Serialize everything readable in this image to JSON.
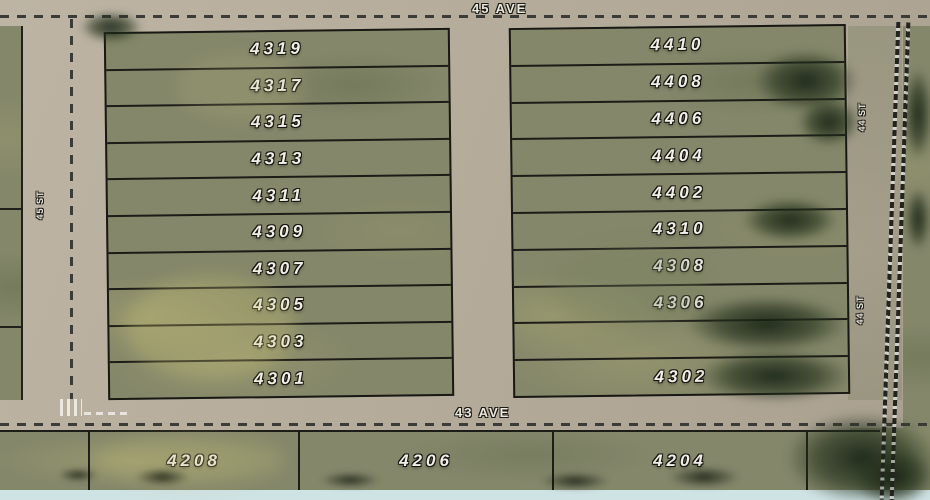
{
  "streets": {
    "top_avenue": "45 AVE",
    "bottom_avenue": "43 AVE",
    "left_street": "45 ST",
    "right_street_upper": "44 ST",
    "right_street_lower": "44 ST"
  },
  "lots": {
    "west": [
      "4319",
      "4317",
      "4315",
      "4313",
      "4311",
      "4309",
      "4307",
      "4305",
      "4303",
      "4301"
    ],
    "east": [
      "4410",
      "4408",
      "4406",
      "4404",
      "4402",
      "4310",
      "4308",
      "4306",
      "",
      "4302"
    ],
    "south": [
      "4208",
      "4206",
      "4204"
    ]
  },
  "colors": {
    "road": "#b7ad9d",
    "parcel_green": "#84876a",
    "tree_dark": "#2e3b2a",
    "boundary": "#1c1c18",
    "label_text": "#f2efe6",
    "bottom_strip": "#cfe2e4"
  }
}
